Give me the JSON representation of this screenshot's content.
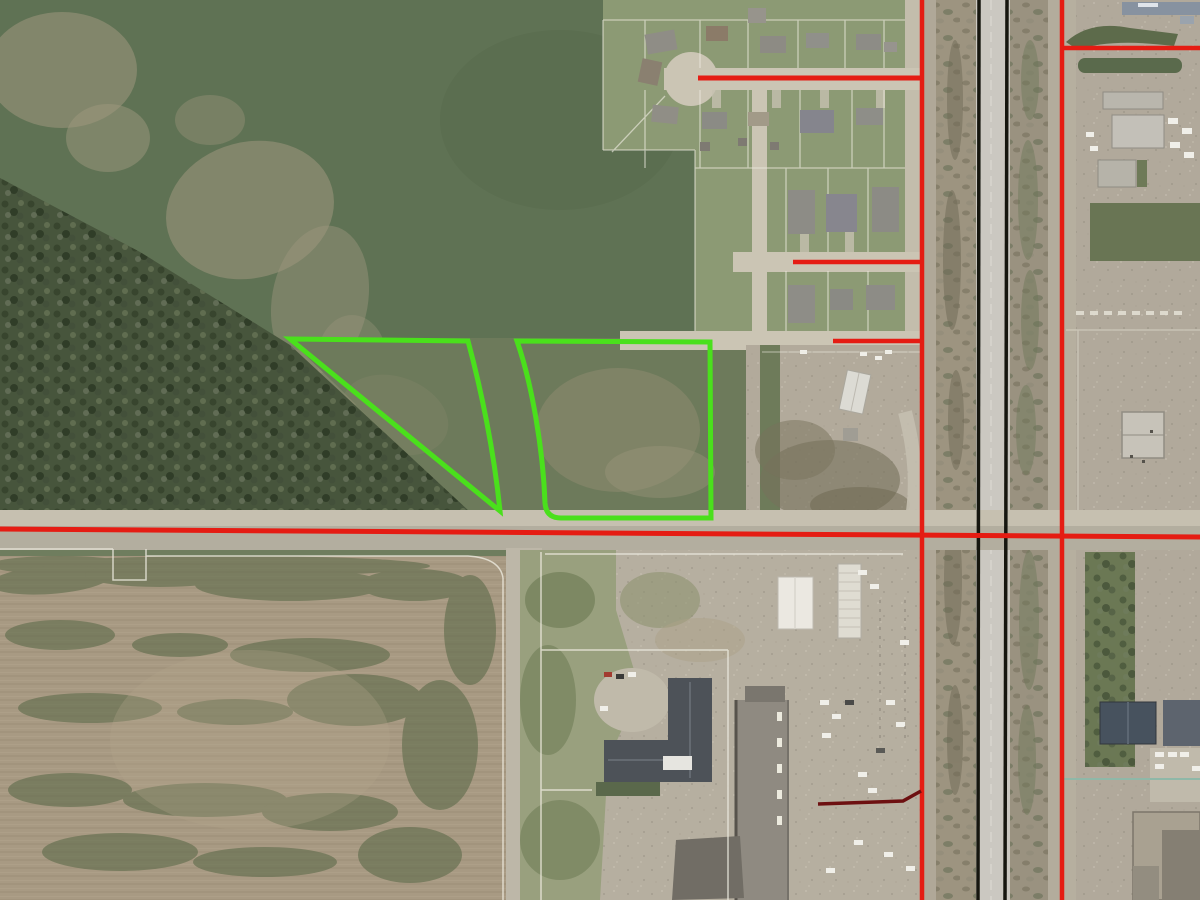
{
  "map": {
    "colors": {
      "road_overlay": "#e51c13",
      "service_road_overlay": "#6d1011",
      "parcel_highlight": "#4ae01c",
      "railway": "#16160f",
      "parcel_boundary": "#eceade",
      "utility_boundary": "#8fb8a8"
    },
    "overlays": {
      "red_road_lines": [
        {
          "name": "road-centerline-main-ew",
          "x1": 0,
          "y1": 529,
          "x2": 1200,
          "y2": 537,
          "w": 5
        },
        {
          "name": "road-centerline-frontage-west",
          "x1": 922,
          "y1": 0,
          "x2": 922,
          "y2": 900,
          "w": 4.5
        },
        {
          "name": "road-centerline-highway-east",
          "x1": 1062,
          "y1": 0,
          "x2": 1062,
          "y2": 900,
          "w": 4.5
        },
        {
          "name": "road-centerline-subdivision-street",
          "x1": 698,
          "y1": 78,
          "x2": 923,
          "y2": 78,
          "w": 5
        },
        {
          "name": "road-centerline-street-north",
          "x1": 793,
          "y1": 262,
          "x2": 923,
          "y2": 262,
          "w": 4.5
        },
        {
          "name": "road-centerline-street-south",
          "x1": 833,
          "y1": 341,
          "x2": 923,
          "y2": 341,
          "w": 4.5
        },
        {
          "name": "road-centerline-east-access",
          "x1": 1062,
          "y1": 48,
          "x2": 1200,
          "y2": 48,
          "w": 4.5
        }
      ],
      "railway_lines": [
        {
          "name": "railway-line-west",
          "x1": 979,
          "y1": 0,
          "x2": 978,
          "y2": 900,
          "w": 3.5
        },
        {
          "name": "railway-line-east",
          "x1": 1007,
          "y1": 0,
          "x2": 1005,
          "y2": 900,
          "w": 3.5
        }
      ],
      "service_road_line": {
        "name": "road-centerline-service",
        "points": "818,804 903,801 921,791",
        "w": 3.5
      },
      "utility_lines": [
        {
          "name": "parcel-line-teal-east",
          "x1": 1062,
          "y1": 779,
          "x2": 1200,
          "y2": 779,
          "w": 2
        }
      ],
      "highlighted_parcels": [
        {
          "name": "highlighted-parcel-west",
          "path": "M 290 339 L 468 341 C 481 389 494 451 500 511 Z",
          "w": 5
        },
        {
          "name": "highlighted-parcel-east",
          "path": "M 517 341 C 532 384 543 449 545 503 Q 546 518 561 518 L 711 518 L 710 342 Z",
          "w": 5
        }
      ]
    }
  }
}
